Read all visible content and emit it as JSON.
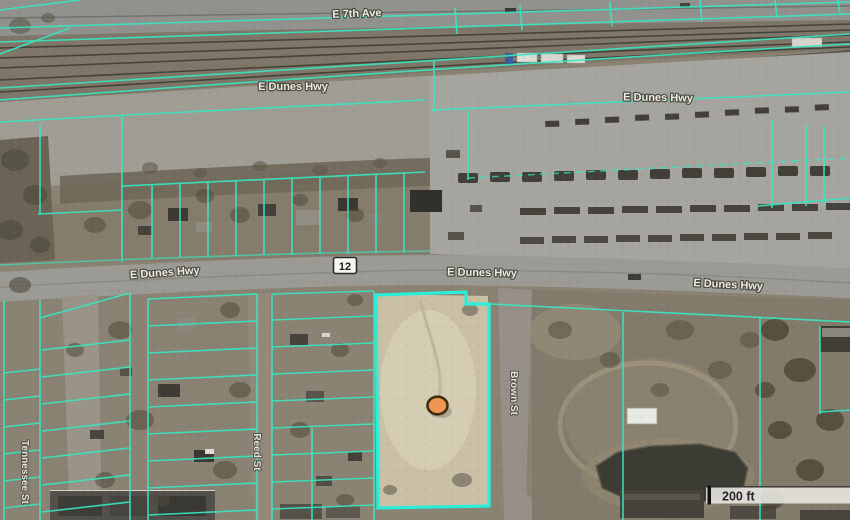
{
  "map": {
    "type": "aerial-parcel-viewer",
    "labels": {
      "e7th_ave": "E 7th Ave",
      "dunes_hwy": "E Dunes Hwy",
      "route_shield": "12",
      "reed_st": "Reed St",
      "tennessee_st": "Tennessee St",
      "brown_st": "Brown St"
    },
    "scale_bar": {
      "label": "200 ft"
    },
    "marker": {
      "fill": "#ee9750",
      "outline": "#3f2e10"
    },
    "colors": {
      "parcel_line": "#39e6c1",
      "parcel_highlight": "#2bedd8",
      "label_text": "#eeece1",
      "label_halo": "#4b4a42"
    }
  }
}
